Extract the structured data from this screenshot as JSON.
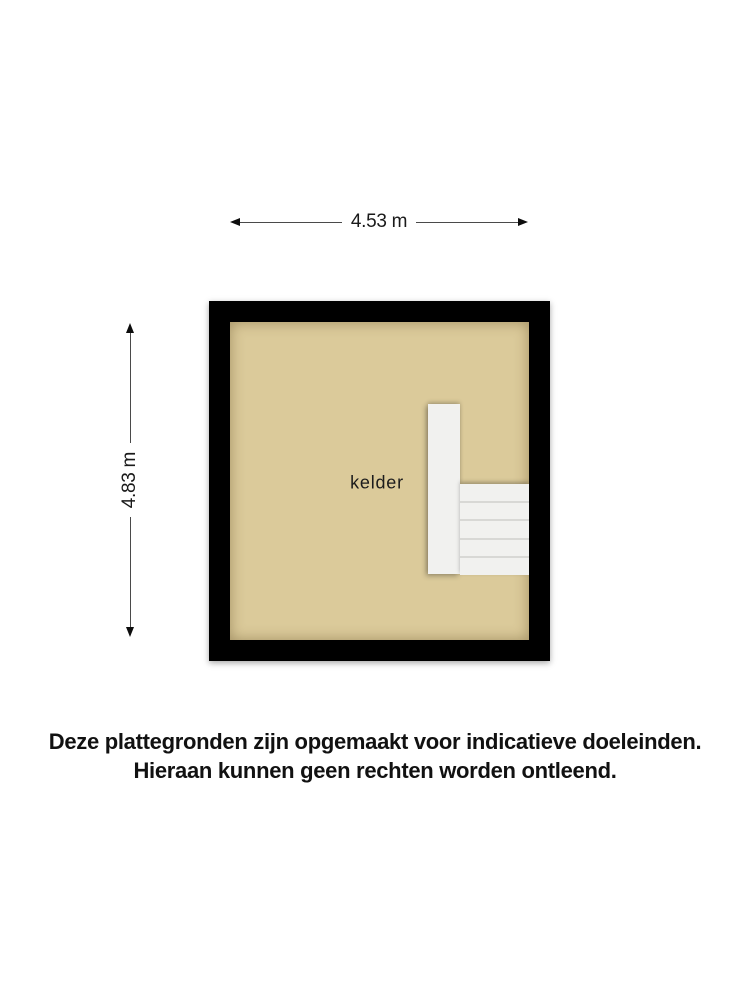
{
  "dimensions": {
    "width": {
      "label": "4.53 m"
    },
    "height": {
      "label": "4.83 m"
    }
  },
  "plan": {
    "room_label": "kelder",
    "staircase": {
      "step_count": 5
    }
  },
  "disclaimer": {
    "line1": "Deze plattegronden zijn opgemaakt voor indicatieve doeleinden.",
    "line2": "Hieraan kunnen geen rechten worden ontleend."
  },
  "colors": {
    "wall": "#000000",
    "floor": "#dbca9a",
    "stairs": "#f1f1ef",
    "stair_divider": "#d8d8d5",
    "dimension_line": "#4a4a4a",
    "text": "#1a1a1a",
    "background": "#ffffff"
  }
}
